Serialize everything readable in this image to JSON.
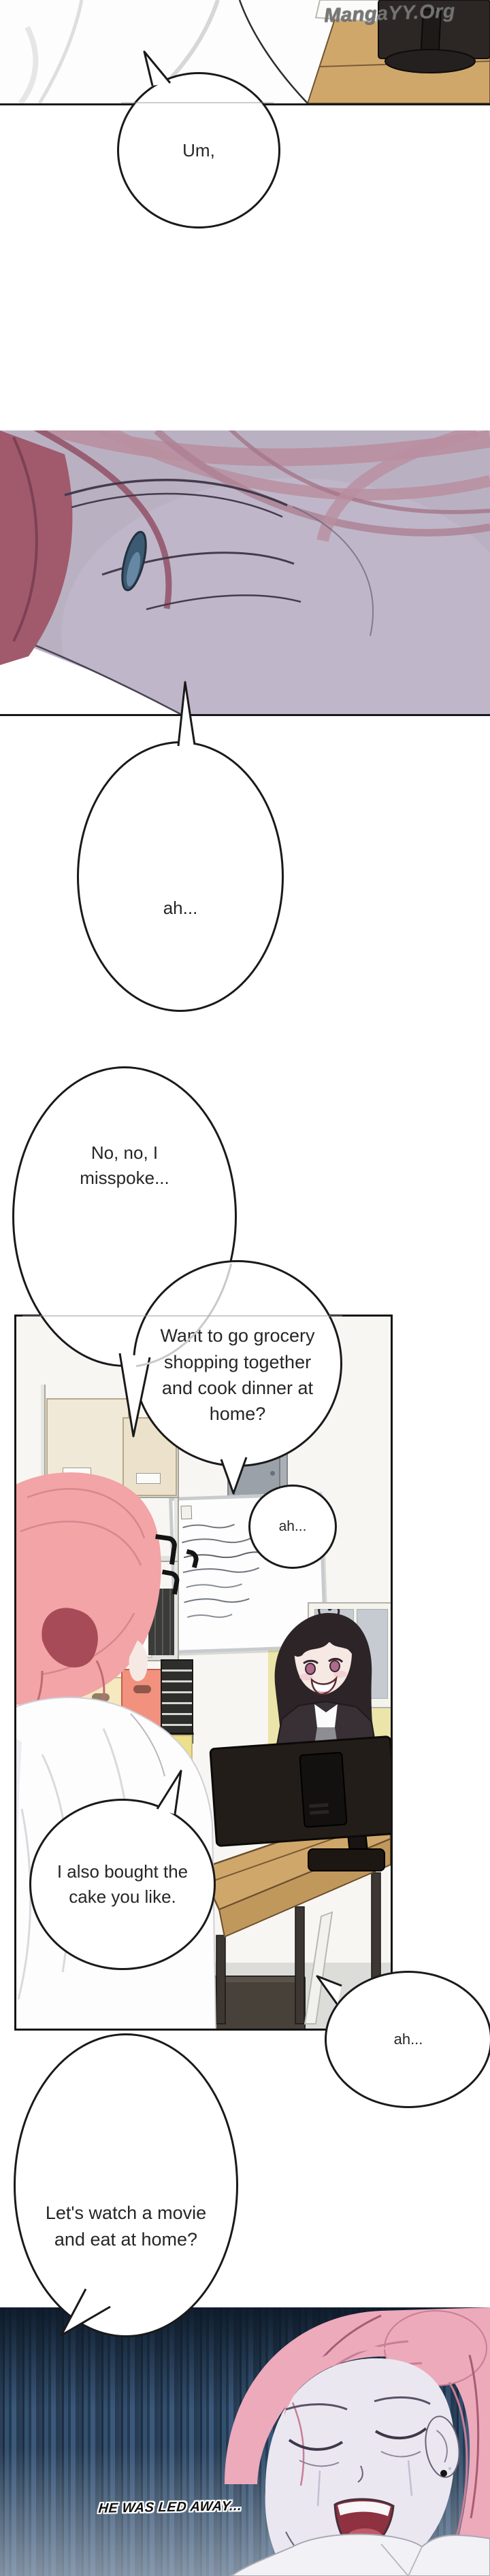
{
  "watermark": {
    "text": "MangaYY.Org"
  },
  "speech": {
    "um": {
      "text": "Um,"
    },
    "soft_ah": {
      "text": "ah..."
    },
    "deny": {
      "lines": [
        "No, no, I",
        "misspoke..."
      ]
    },
    "grocery": {
      "lines": [
        "Want to go grocery",
        "shopping together",
        "and cook dinner at",
        "home?"
      ]
    },
    "ah_reply_1": {
      "text": "ah..."
    },
    "cake": {
      "lines": [
        "I also bought the",
        "cake you like."
      ]
    },
    "ah_reply_2": {
      "text": "ah..."
    },
    "movie": {
      "lines": [
        "Let's watch a movie",
        "and eat at home?"
      ]
    }
  },
  "caption": {
    "text": "HE WAS LED AWAY..."
  },
  "icons": {
    "confusion_marks": "three hook tick marks beside pink-haired character",
    "closed_eye": "blue half-lidded eye sliver in face close-up",
    "earring": "black stud earring on ear in night panel"
  },
  "colors": {
    "bubble_outline": "#1a1a1a",
    "face_panel_bg": "#b9b1c2",
    "hair_pink": "#f2a4a6",
    "hair_dark_red": "#a84b58",
    "eye_blue": "#6f99c0",
    "coral_box": "#f2917e",
    "desk_wood": "#d0a76b",
    "wall_yellow": "#ece5a9",
    "night_top": "#1c2e41",
    "night_bottom": "#93a5b8"
  }
}
